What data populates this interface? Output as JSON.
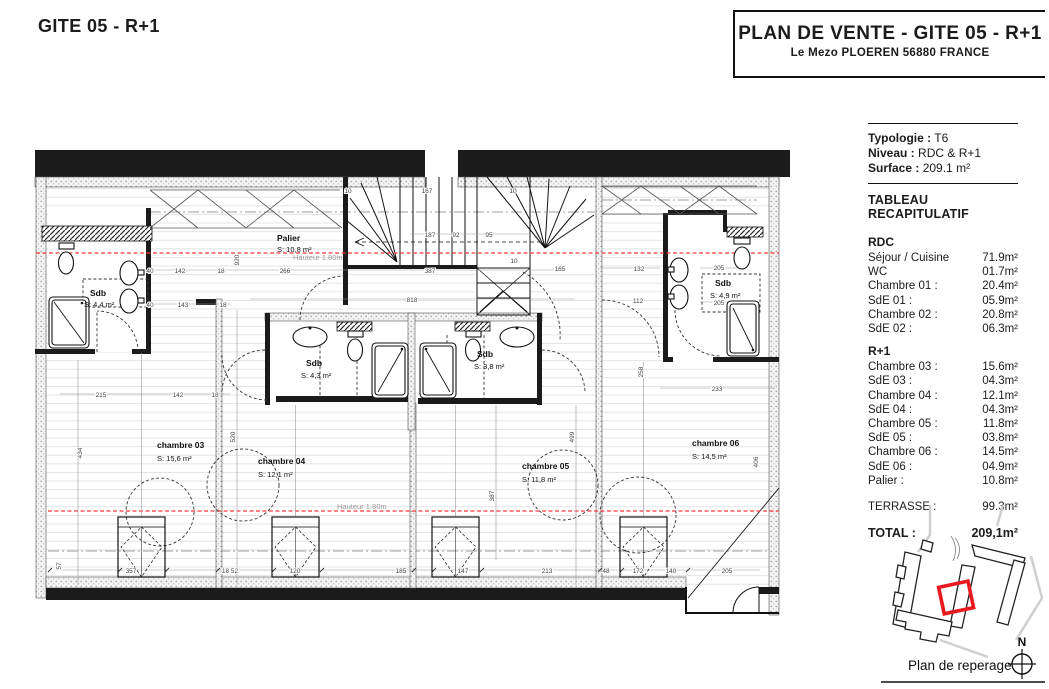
{
  "page_title": "GITE 05 - R+1",
  "header": {
    "title": "PLAN DE VENTE - GITE 05 - R+1",
    "subtitle": "Le Mezo PLOEREN 56880 FRANCE"
  },
  "sidebar": {
    "info": [
      {
        "label": "Typologie :",
        "value": "T6"
      },
      {
        "label": "Niveau :",
        "value": "RDC & R+1"
      },
      {
        "label": "Surface :",
        "value": "209.1 m²"
      }
    ],
    "table_title": "TABLEAU RECAPITULATIF",
    "rdc_title": "RDC",
    "rdc_rows": [
      {
        "label": "Séjour / Cuisine",
        "value": "71.9m²"
      },
      {
        "label": "WC",
        "value": "01.7m²"
      },
      {
        "label": "Chambre 01 :",
        "value": "20.4m²"
      },
      {
        "label": "SdE 01 :",
        "value": "05.9m²"
      },
      {
        "label": "Chambre 02 :",
        "value": "20.8m²"
      },
      {
        "label": "SdE 02 :",
        "value": "06.3m²"
      }
    ],
    "r1_title": "R+1",
    "r1_rows": [
      {
        "label": "Chambre 03 :",
        "value": "15.6m²"
      },
      {
        "label": "SdE 03 :",
        "value": "04.3m²"
      },
      {
        "label": "Chambre 04 :",
        "value": "12.1m²"
      },
      {
        "label": "SdE 04 :",
        "value": "04.3m²"
      },
      {
        "label": "Chambre 05 :",
        "value": "11.8m²"
      },
      {
        "label": "SdE 05 :",
        "value": "03.8m²"
      },
      {
        "label": "Chambre 06 :",
        "value": "14.5m²"
      },
      {
        "label": "SdE 06 :",
        "value": "04.9m²"
      },
      {
        "label": "Palier :",
        "value": "10.8m²"
      }
    ],
    "terrasse": {
      "label": "TERRASSE :",
      "value": "99.3m²"
    },
    "total": {
      "label": "TOTAL :",
      "value": "209,1m²"
    },
    "map_caption": "Plan de reperage",
    "north": "N"
  },
  "plan": {
    "rooms": [
      {
        "name": "Palier",
        "area": "S: 10,8 m²"
      },
      {
        "name": "Sdb",
        "area": "S: 4,4 m²"
      },
      {
        "name": "Sdb",
        "area": "S: 4,3 m²"
      },
      {
        "name": "Sdb",
        "area": "S: 3,8 m²"
      },
      {
        "name": "Sdb",
        "area": "S: 4,9 m²"
      },
      {
        "name": "chambre 03",
        "area": "S:    15,6 m²"
      },
      {
        "name": "chambre 04",
        "area": "S:    12,1 m²"
      },
      {
        "name": "chambre 05",
        "area": "S:    11,8 m²"
      },
      {
        "name": "chambre 06",
        "area": "S:    14,5 m²"
      }
    ],
    "height_note": "Hauteur 1.80m",
    "dims": [
      "266",
      "387",
      "165",
      "818",
      "187",
      "92",
      "95",
      "167",
      "142",
      "18",
      "40",
      "143",
      "18",
      "40",
      "215",
      "142",
      "18",
      "205",
      "205",
      "233",
      "132",
      "112",
      "357",
      "120",
      "185",
      "147",
      "213",
      "48",
      "172",
      "140",
      "205",
      "434",
      "520",
      "499",
      "387",
      "406",
      "258",
      "57",
      "920",
      "18 52",
      "10",
      "10",
      "10"
    ]
  },
  "colors": {
    "accent_red": "#e8191f",
    "guide_line_red": "#ff3b3b",
    "wall_black": "#1b1b1b"
  }
}
